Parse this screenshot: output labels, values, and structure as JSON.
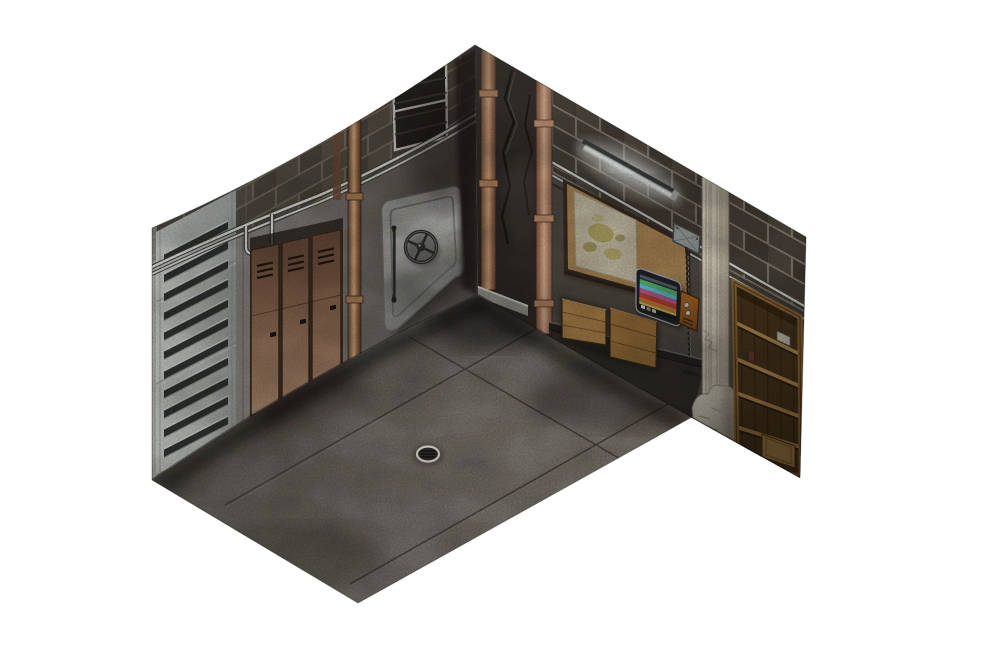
{
  "meta": {
    "title": "Isometric bunker corner room map tile",
    "description": "Cutaway isometric view of a concrete bunker room: left wall with louvered metal shutter, three rusted lockers and a steel vault door with spinner wheel; cracked stone corner column with copper pipes; right wall with cinder-block top course, fluorescent tube light, corkboard with pinned map, wall monitor showing color test bars, orange intercom panel, hanging pull chain, wooden crate lids on a rail, crumbling plaster pipe chase with rubble, and a wooden storage shelf; bare concrete floor with expansion joints and a round metal drain.",
    "view": "isometric corner cutaway on white background"
  },
  "palette": {
    "background": "#ffffff",
    "concrete_floor": "#716c67",
    "concrete_left": "#7a7571",
    "concrete_right": "#57514a",
    "brick_left": "#4e4840",
    "mortar_left": "#6e675a",
    "brick_right": "#474039",
    "mortar_right": "#847c6e",
    "metal_louver": "#b6bab6",
    "rust": "#8a6750",
    "steel_vault": "#a7a7a3",
    "stone_corner": "#38332f",
    "copper": "#b98a66",
    "pipe_steel": "#d6d8d2",
    "cork": "#bf9963",
    "map_paper": "#d6ccb1",
    "wood_crate": "#b5894e",
    "wood_shelf_frame": "#8f6836",
    "wood_interior": "#503a1f",
    "plaster": "#d6d0c2",
    "orange_panel": "#a86224",
    "monitor_frame": "#20242a",
    "glow": "#f5f8f4",
    "shadow": "#17130f",
    "drain_metal": "#b7b4ae"
  },
  "objects": {
    "floor": {
      "label": "concrete floor slab",
      "color": "#716c67"
    },
    "floor_drain": {
      "label": "round metal floor drain"
    },
    "floor_seams": {
      "label": "expansion joints in concrete floor"
    },
    "left_wall": {
      "label": "left concrete wall with cinder-block top course",
      "color": "#7a7571"
    },
    "right_wall": {
      "label": "right concrete wall with cinder-block top course",
      "color": "#57514a"
    },
    "louver_panel": {
      "label": "louvered metal shutter panel",
      "color": "#b6bab6",
      "slat_count": 11
    },
    "vent_grille": {
      "label": "wall ventilation grille"
    },
    "wall_lockers": {
      "label": "three rusted metal lockers",
      "color": "#8a6750",
      "door_count": 3
    },
    "vault_door": {
      "label": "steel vault door with spinner wheel",
      "color": "#a7a7a3"
    },
    "vault_wheel": {
      "label": "vault door locking wheel"
    },
    "corner_column": {
      "label": "cracked dark stone corner column",
      "color": "#38332f"
    },
    "copper_pipes": {
      "label": "vertical copper pipes",
      "color": "#b98a66"
    },
    "utility_pipes": {
      "label": "thin steel utility pipes",
      "color": "#d6d8d2"
    },
    "fluorescent_light": {
      "label": "fluorescent tube light",
      "color": "#f5f8f4"
    },
    "corkboard": {
      "label": "cork notice board",
      "color": "#bf9963"
    },
    "wall_map": {
      "label": "pinned map on corkboard",
      "color": "#d6ccb1"
    },
    "monitor": {
      "label": "wall-mounted monitor showing color test bars",
      "frame": "#20242a",
      "stripes": [
        "#27303c",
        "#5cb96e",
        "#5fccd8",
        "#c05e9b",
        "#c24136",
        "#cb7c38",
        "#d2c45a"
      ],
      "blocks": [
        "#e9e9e7",
        "#9b9b99",
        "#c7c7c3"
      ]
    },
    "intercom_panel": {
      "label": "orange intercom panel with knobs",
      "color": "#a86224"
    },
    "junction_box": {
      "label": "electrical junction box",
      "color": "#98a09e"
    },
    "pull_chain": {
      "label": "hanging pull chain with handle"
    },
    "shelf_rail": {
      "label": "dark metal shelf rail"
    },
    "wooden_crates": {
      "label": "wooden crate lids resting on rail",
      "color": "#b5894e"
    },
    "plaster_column": {
      "label": "crumbling plaster pipe chase",
      "color": "#d6d0c2"
    },
    "rubble": {
      "label": "plaster rubble heap at wall base"
    },
    "bookshelf": {
      "label": "wooden storage shelf unit",
      "color": "#8f6836",
      "shelf_count": 4
    }
  }
}
